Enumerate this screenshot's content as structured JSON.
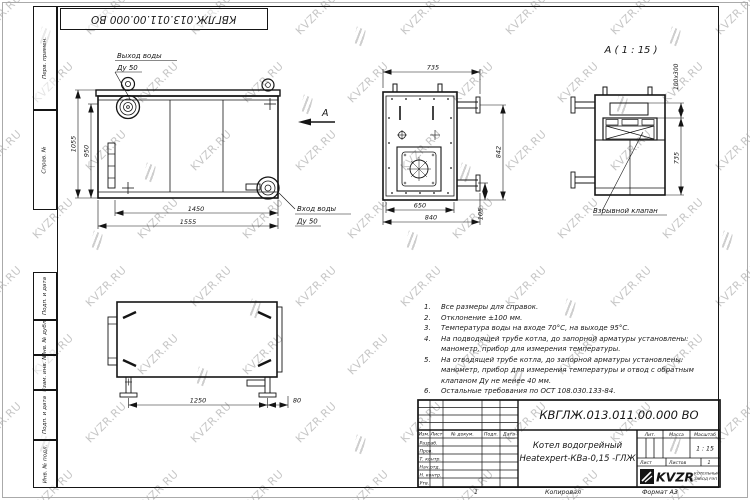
{
  "watermark": {
    "text": "KVZR.RU"
  },
  "frame": {
    "top_stamp": "КВГЛЖ.013.011.00.000 ВО",
    "side_labels": [
      "Перв. примен.",
      "Справ. №",
      "Подп. и дата",
      "Инв. № дубл.",
      "Взам. инв. №",
      "Подп. и дата",
      "Инв. № подл."
    ]
  },
  "views": {
    "front": {
      "outlet_line1": "Выход воды",
      "outlet_line2": "Ду 50",
      "inlet_line1": "Вход воды",
      "inlet_line2": "Ду 50",
      "view_arrow_letter": "А",
      "dims": {
        "height_overall": "1055",
        "height_body": "950",
        "width_body": "1450",
        "width_overall": "1555"
      }
    },
    "side": {
      "dims": {
        "width_top": "735",
        "height": "842",
        "width_inner": "650",
        "width_overall": "840",
        "offset": "105"
      }
    },
    "detail": {
      "title": "А ( 1 : 15 )",
      "valve_label": "Взрывной клапан",
      "dims": {
        "valve_size": "100x300",
        "height": "735"
      }
    },
    "top": {
      "dims": {
        "length": "1250",
        "offset": "80"
      }
    }
  },
  "notes": {
    "items": [
      {
        "n": "1.",
        "t": "Все размеры для справок."
      },
      {
        "n": "2.",
        "t": "Отклонение ±100 мм."
      },
      {
        "n": "3.",
        "t": "Температура воды на входе 70°С, на выходе 95°С."
      },
      {
        "n": "4.",
        "t": "На подводящей трубе котла, до запорной арматуры установлены: манометр, прибор для измерения температуры."
      },
      {
        "n": "5.",
        "t": "На отводящей трубе котла, до запорной арматуры установлены: манометр, прибор для измерения температуры и отвод с обратным клапаном Ду не менее 40 мм."
      },
      {
        "n": "6.",
        "t": "Остальные требования по ОСТ 108.030.133-84."
      }
    ]
  },
  "title_block": {
    "designation": "КВГЛЖ.013.011.00.000 ВО",
    "product_line1": "Котел водогрейный",
    "product_line2": "Heatexpert-КВа-0,15 -ГЛЖ",
    "headers": {
      "izm": "Изм.",
      "list": "Лист",
      "doc": "№ докум.",
      "sign": "Подп.",
      "date": "Дата",
      "lit": "Лит.",
      "mass": "Масса",
      "scale": "Масштаб",
      "sheet": "Лист",
      "sheets": "Листов"
    },
    "rows": [
      "Разраб.",
      "Пров.",
      "Т. контр.",
      "Нач.отд.",
      "Н. контр.",
      "Утв."
    ],
    "scale_value": "1 : 15",
    "sheets_value": "1",
    "company": {
      "logo": "KVZR",
      "line1": "КОТЕЛЬНЫЙ",
      "line2": "ЗАВОД РЭП"
    }
  },
  "footer": {
    "page_mark": "1",
    "copied": "Копировал",
    "format": "Формат А3"
  }
}
